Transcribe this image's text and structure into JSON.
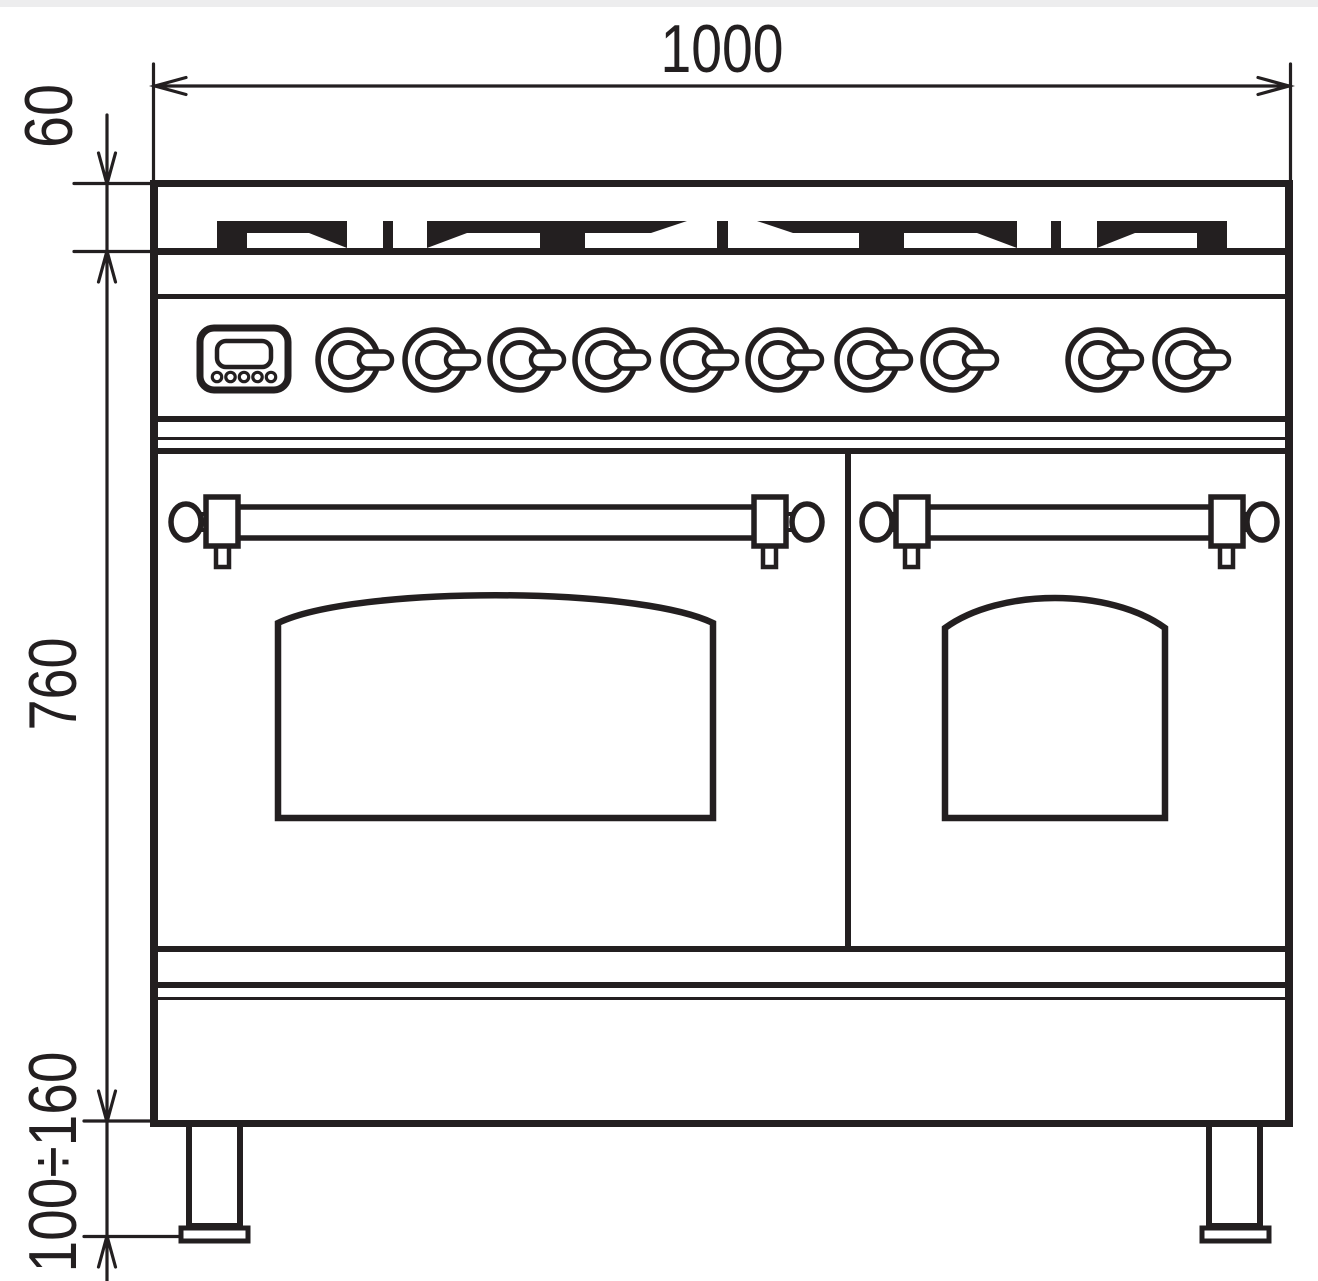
{
  "page": {
    "background_color": "#ffffff",
    "line_color": "#231f20",
    "top_edge_strip_color": "#ededee"
  },
  "drawing": {
    "description": "Front elevation dimension drawing of a double-oven range cooker",
    "dimension_labels": {
      "overall_width": "1000",
      "hob_height": "60",
      "body_height": "760",
      "leg_height_range": "100÷160"
    },
    "features": {
      "knob_count": 10,
      "display_button_count": 5,
      "oven_door_count": 2,
      "leg_count": 2
    }
  }
}
